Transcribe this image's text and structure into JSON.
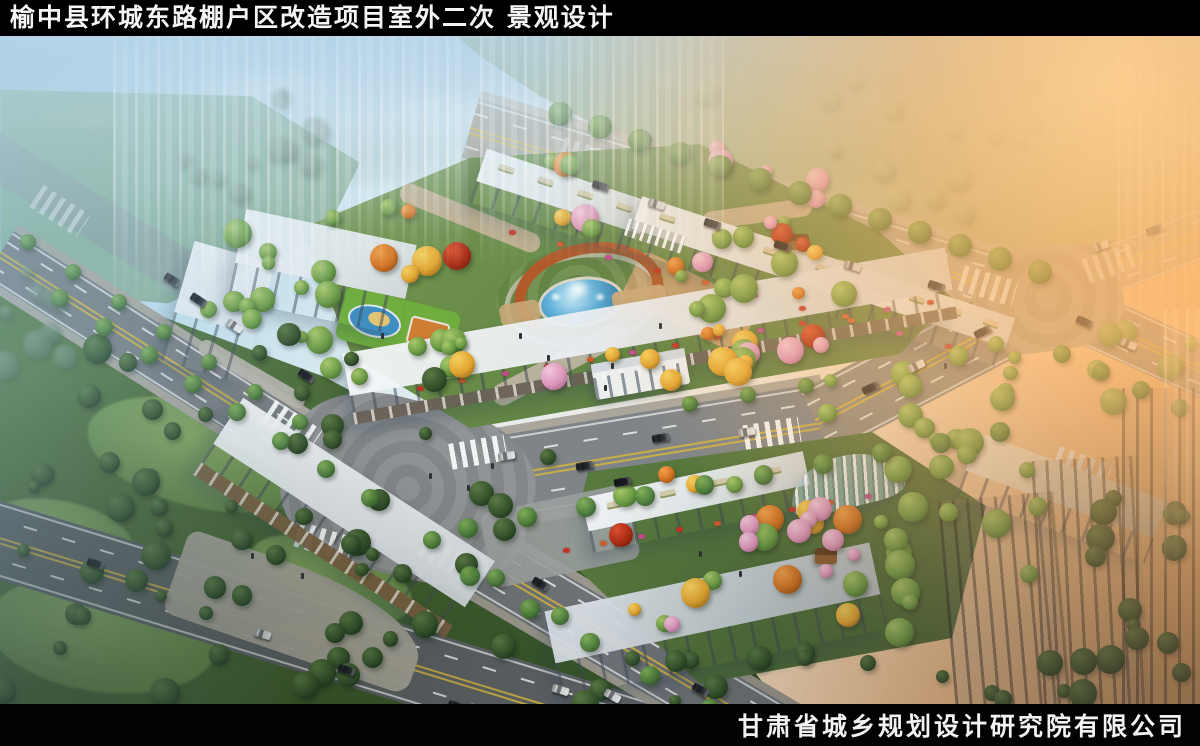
{
  "header": {
    "title": "榆中县环城东路棚户区改造项目室外二次 景观设计"
  },
  "footer": {
    "company": "甘肃省城乡规划设计研究院有限公司"
  },
  "palette": {
    "bar_bg": "#000000",
    "bar_text": "#f4f4f2",
    "asphalt": "#75797c",
    "lane_yellow": "#d2b340",
    "lane_white": "#eceeee",
    "building_roof": "#f6f8fa",
    "building_front": "#9aa4ae",
    "pergola_rust": "#b25a2a",
    "pool_blue": "#4fa8d6",
    "flower_red": "#c23326"
  },
  "scene": {
    "palettes": {
      "green": [
        "#a8c86a",
        "#6a9a44",
        "#3c6428"
      ],
      "dark": [
        "#5a7a44",
        "#35522c",
        "#16301a"
      ],
      "autumn": [
        "#f5d060",
        "#e0a430",
        "#96651a"
      ],
      "orange": [
        "#f0a04a",
        "#cf7020",
        "#8a4812"
      ],
      "pink": [
        "#f2c6da",
        "#dc96bc",
        "#a86088"
      ],
      "red": [
        "#d85030",
        "#aa2c14",
        "#6a1c08"
      ],
      "haze": [
        "#b8c49a",
        "#93a878",
        "#6f8a5c"
      ],
      "hazedark": [
        "#8aa08a",
        "#5f7a62",
        "#405a44"
      ],
      "street": [
        "#7fae56",
        "#4a7c36",
        "#2a4c22"
      ]
    },
    "roads": [
      {
        "p": [
          -20,
          110,
          215,
          255
        ],
        "w": 44,
        "color": "#8d979c",
        "op": 0.55,
        "marks": false
      },
      {
        "p": [
          470,
          86,
          1052,
          260
        ],
        "w": 66,
        "color": "#a8a193",
        "op": 0.8,
        "marks": true,
        "walk": "#c2b9a8"
      },
      {
        "p": [
          1048,
          258,
          1225,
          188
        ],
        "w": 50,
        "color": "#b3a690",
        "op": 0.7,
        "marks": true
      },
      {
        "p": [
          1048,
          264,
          1220,
          342
        ],
        "w": 54,
        "color": "#9c9488",
        "op": 0.92,
        "marks": true
      },
      {
        "p": [
          0,
          210,
          406,
          468
        ],
        "w": 54,
        "color": "#75797c",
        "op": 1,
        "marks": true,
        "walk": "#a8a49a"
      },
      {
        "p": [
          -20,
          498,
          660,
          706
        ],
        "w": 76,
        "color": "#5c6064",
        "op": 1,
        "marks": true
      },
      {
        "p": [
          390,
          452,
          828,
          380
        ],
        "w": 84,
        "color": "#7f8488",
        "op": 1,
        "marks": true,
        "walk": "#aaa69c"
      },
      {
        "p": [
          816,
          386,
          1054,
          262
        ],
        "w": 70,
        "color": "#8b8a82",
        "op": 1,
        "marks": true
      },
      {
        "p": [
          398,
          468,
          792,
          700
        ],
        "w": 62,
        "color": "#6d7276",
        "op": 1,
        "marks": true,
        "walk": "#9a968c"
      }
    ],
    "junctions": [
      {
        "cx": 408,
        "cy": 452,
        "w": 250,
        "h": 175,
        "rot": 14,
        "color": "#898d8f"
      },
      {
        "cx": 1048,
        "cy": 262,
        "w": 150,
        "h": 105,
        "rot": -8,
        "color": "#b5a78e"
      }
    ],
    "crosswalks": [
      [
        292,
        390,
        33,
        1
      ],
      [
        478,
        416,
        -10,
        1
      ],
      [
        448,
        522,
        30,
        1
      ],
      [
        324,
        506,
        17,
        1
      ],
      [
        772,
        398,
        -9,
        1
      ],
      [
        988,
        250,
        17,
        0.8
      ],
      [
        1112,
        226,
        -20,
        0.6
      ],
      [
        1082,
        432,
        20,
        0.9
      ],
      [
        588,
        122,
        17,
        0.5
      ],
      [
        60,
        175,
        33,
        0.5
      ]
    ],
    "lawns": [
      [
        200,
        418,
        230,
        105,
        14
      ],
      [
        102,
        598,
        230,
        115,
        8
      ],
      [
        330,
        544,
        170,
        78,
        18
      ],
      [
        60,
        500,
        150,
        70,
        12
      ]
    ],
    "ponds": [
      [
        40,
        328,
        130,
        84
      ],
      [
        982,
        206,
        56,
        18
      ]
    ],
    "paths": [
      [
        470,
        182,
        150,
        20,
        22,
        "#c2b093"
      ],
      [
        560,
        328,
        150,
        22,
        -28,
        "#bdb5a4"
      ],
      [
        690,
        266,
        130,
        54,
        26,
        "#c8a272"
      ],
      [
        252,
        338,
        120,
        16,
        30,
        "#b5b2a8"
      ],
      [
        757,
        178,
        110,
        18,
        -8,
        "#c2b093"
      ],
      [
        872,
        250,
        90,
        16,
        30,
        "#c8b89a"
      ]
    ],
    "buildings": [
      {
        "cx": 560,
        "cy": 166,
        "w": 172,
        "h": 56,
        "rot": 18,
        "planters": true
      },
      {
        "cx": 742,
        "cy": 222,
        "w": 228,
        "h": 56,
        "rot": 18,
        "planters": true
      },
      {
        "cx": 930,
        "cy": 282,
        "w": 162,
        "h": 52,
        "rot": 18,
        "planters": true
      },
      {
        "cx": 218,
        "cy": 276,
        "w": 84,
        "h": 124,
        "rot": 16
      },
      {
        "cx": 322,
        "cy": 236,
        "w": 174,
        "h": 92,
        "rot": 12
      },
      {
        "cx": 650,
        "cy": 300,
        "w": 612,
        "h": 72,
        "rot": -10,
        "arcade": "#6a6158"
      },
      {
        "cx": 344,
        "cy": 482,
        "w": 300,
        "h": 92,
        "rot": 33,
        "arcade": "#7a5f42"
      },
      {
        "cx": 698,
        "cy": 466,
        "w": 226,
        "h": 56,
        "rot": -12,
        "planters": true
      },
      {
        "cx": 716,
        "cy": 584,
        "w": 332,
        "h": 88,
        "rot": -12,
        "shade": true
      },
      {
        "cx": 1062,
        "cy": 462,
        "w": 200,
        "h": 66,
        "rot": 20,
        "warm": true
      },
      {
        "cx": 1006,
        "cy": 580,
        "w": 116,
        "h": 240,
        "rot": -5,
        "dark": true
      },
      {
        "cx": 1092,
        "cy": 572,
        "w": 106,
        "h": 300,
        "rot": -3,
        "dark": true
      },
      {
        "cx": 1170,
        "cy": 532,
        "w": 96,
        "h": 360,
        "rot": 0,
        "dark": true
      }
    ],
    "structures": {
      "plaza": {
        "cx": 578,
        "cy": 259
      },
      "gate_main": {
        "cx": 640,
        "cy": 338,
        "rot": -10
      },
      "trellis_north": {
        "cx": 655,
        "cy": 200,
        "rot": 18
      },
      "canopy": {
        "cx": 845,
        "cy": 446,
        "rot": -14
      },
      "gazebos": [
        [
          798,
          206
        ],
        [
          826,
          520
        ]
      ],
      "playground": {
        "cx": 398,
        "cy": 290,
        "rot": 14
      },
      "plaza_wedge": {
        "cx": 298,
        "cy": 576,
        "w": 258,
        "h": 88,
        "rot": 19
      },
      "plaza_b2": {
        "cx": 560,
        "cy": 500,
        "w": 150,
        "h": 76,
        "rot": -12
      }
    },
    "flower_rows": [
      [
        420,
        352,
        930,
        266,
        13
      ],
      [
        566,
        514,
        868,
        460,
        9
      ],
      [
        512,
        196,
        948,
        310,
        10
      ]
    ],
    "tree_regions": [
      {
        "x": 130,
        "y": 58,
        "w": 210,
        "h": 120,
        "n": 11,
        "pal": "hazedark",
        "blur": 2,
        "op": 0.55
      },
      {
        "x": 0,
        "y": 220,
        "w": 130,
        "h": 110,
        "n": 9,
        "pal": "hazedark",
        "blur": 1.5,
        "op": 0.6
      },
      {
        "x": 540,
        "y": 36,
        "w": 520,
        "h": 190,
        "n": 30,
        "pal": "haze",
        "blur": 1.5,
        "op": 0.65,
        "line": [
          470,
          74,
          1052,
          248
        ]
      },
      {
        "x": 310,
        "y": 148,
        "w": 150,
        "h": 200,
        "n": 14,
        "pal": "mixed"
      },
      {
        "x": 450,
        "y": 118,
        "w": 160,
        "h": 226,
        "n": 16,
        "pal": "mixed",
        "avoid": true
      },
      {
        "x": 600,
        "y": 140,
        "w": 150,
        "h": 186,
        "n": 14,
        "pal": "mixed",
        "avoid": true
      },
      {
        "x": 738,
        "y": 182,
        "w": 132,
        "h": 156,
        "n": 12,
        "pal": "mixed"
      },
      {
        "x": 610,
        "y": 258,
        "w": 140,
        "h": 104,
        "n": 9,
        "pal": "autumn",
        "avoid": true
      },
      {
        "x": 188,
        "y": 178,
        "w": 150,
        "h": 150,
        "n": 12,
        "pal": "green"
      },
      {
        "x": 700,
        "y": 112,
        "w": 120,
        "h": 86,
        "n": 7,
        "pal": "pink"
      },
      {
        "x": 820,
        "y": 300,
        "w": 200,
        "h": 120,
        "n": 15,
        "pal": "green"
      },
      {
        "x": 620,
        "y": 420,
        "w": 300,
        "h": 180,
        "n": 20,
        "pal": "mixed"
      },
      {
        "x": 744,
        "y": 452,
        "w": 120,
        "h": 92,
        "n": 8,
        "pal": "pink"
      },
      {
        "x": 856,
        "y": 416,
        "w": 190,
        "h": 160,
        "n": 14,
        "pal": "green"
      },
      {
        "x": 0,
        "y": 298,
        "w": 560,
        "h": 366,
        "n": 62,
        "pal": "dark"
      },
      {
        "x": 560,
        "y": 596,
        "w": 470,
        "h": 72,
        "n": 16,
        "pal": "dark"
      },
      {
        "x": 1040,
        "y": 428,
        "w": 160,
        "h": 236,
        "n": 18,
        "pal": "dark"
      },
      {
        "x": 1095,
        "y": 292,
        "w": 105,
        "h": 96,
        "n": 7,
        "pal": "green",
        "op": 0.85
      }
    ],
    "tree_rows": [
      [
        60,
        262,
        370,
        462,
        8,
        10
      ],
      [
        28,
        206,
        300,
        386,
        7,
        9
      ],
      [
        468,
        492,
        1000,
        396,
        10,
        11
      ],
      [
        690,
        368,
        806,
        350,
        3,
        9
      ],
      [
        470,
        540,
        770,
        706,
        6,
        11
      ],
      [
        432,
        504,
        560,
        580,
        3,
        10
      ],
      [
        560,
        78,
        1040,
        236,
        13,
        13
      ],
      [
        1062,
        318,
        1180,
        372,
        4,
        10
      ]
    ],
    "cars": [
      [
        198,
        264,
        33,
        "#23262b"
      ],
      [
        234,
        290,
        33,
        "#e6e8e8"
      ],
      [
        172,
        244,
        33,
        "#3a3e44"
      ],
      [
        306,
        340,
        33,
        "#202329"
      ],
      [
        506,
        420,
        -9,
        "#d6d8da"
      ],
      [
        584,
        430,
        -9,
        "#25282e"
      ],
      [
        660,
        402,
        -9,
        "#2a2d33"
      ],
      [
        746,
        396,
        -9,
        "#dadcde"
      ],
      [
        622,
        446,
        -9,
        "#17191d"
      ],
      [
        870,
        352,
        -25,
        "#23262b"
      ],
      [
        916,
        330,
        -25,
        "#e2e4e4"
      ],
      [
        982,
        296,
        -25,
        "#2a2e34"
      ],
      [
        540,
        548,
        31,
        "#23262b"
      ],
      [
        612,
        660,
        31,
        "#d8dadc"
      ],
      [
        700,
        654,
        31,
        "#2a2d33"
      ],
      [
        756,
        688,
        31,
        "#101317"
      ],
      [
        95,
        528,
        17,
        "#1c1f24"
      ],
      [
        262,
        598,
        17,
        "#d8dadc"
      ],
      [
        346,
        634,
        17,
        "#23262b"
      ],
      [
        456,
        670,
        17,
        "#2a2d33"
      ],
      [
        560,
        654,
        17,
        "#dadcdc"
      ],
      [
        600,
        150,
        17,
        "#2e3238"
      ],
      [
        656,
        168,
        17,
        "#d8dadc"
      ],
      [
        712,
        188,
        17,
        "#2a2e34"
      ],
      [
        782,
        210,
        17,
        "#15171b"
      ],
      [
        852,
        230,
        17,
        "#d0d4d6"
      ],
      [
        936,
        250,
        17,
        "#2a2e34"
      ],
      [
        1100,
        210,
        -20,
        "#d8dadc"
      ],
      [
        1154,
        194,
        -20,
        "#2a2e34"
      ],
      [
        1084,
        286,
        24,
        "#23262b"
      ],
      [
        1128,
        308,
        24,
        "#d8dadc"
      ]
    ],
    "figures": [
      [
        520,
        300
      ],
      [
        548,
        322
      ],
      [
        612,
        330
      ],
      [
        660,
        290
      ],
      [
        430,
        440
      ],
      [
        468,
        452
      ],
      [
        252,
        520
      ],
      [
        302,
        540
      ],
      [
        700,
        518
      ],
      [
        740,
        538
      ],
      [
        945,
        330
      ],
      [
        382,
        300
      ],
      [
        492,
        430
      ],
      [
        605,
        352
      ]
    ]
  }
}
